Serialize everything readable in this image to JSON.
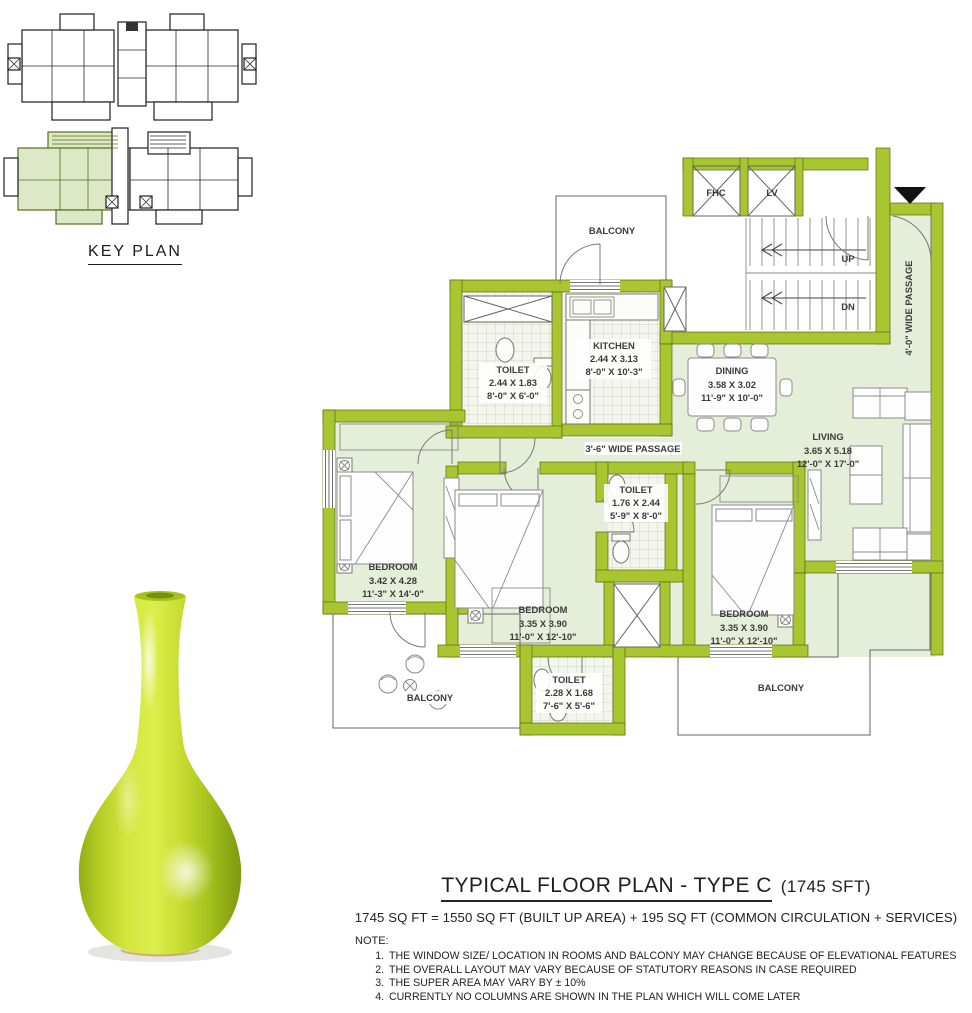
{
  "key_plan": {
    "title": "KEY PLAN"
  },
  "floor_plan": {
    "rooms": {
      "balcony_top": {
        "name": "BALCONY"
      },
      "kitchen": {
        "name": "KITCHEN",
        "metric": "2.44 X 3.13",
        "imperial": "8'-0\" X 10'-3\""
      },
      "toilet_1": {
        "name": "TOILET",
        "metric": "2.44 X 1.83",
        "imperial": "8'-0\" X 6'-0\""
      },
      "dining": {
        "name": "DINING",
        "metric": "3.58 X 3.02",
        "imperial": "11'-9\" X 10'-0\""
      },
      "living": {
        "name": "LIVING",
        "metric": "3.65 X 5.18",
        "imperial": "12'-0\" X 17'-0\""
      },
      "bedroom_1": {
        "name": "BEDROOM",
        "metric": "3.42 X 4.28",
        "imperial": "11'-3\" X 14'-0\""
      },
      "bedroom_2": {
        "name": "BEDROOM",
        "metric": "3.35 X 3.90",
        "imperial": "11'-0\" X 12'-10\""
      },
      "toilet_2": {
        "name": "TOILET",
        "metric": "1.76 X 2.44",
        "imperial": "5'-9\" X 8'-0\""
      },
      "bedroom_3": {
        "name": "BEDROOM",
        "metric": "3.35 X 3.90",
        "imperial": "11'-0\" X 12'-10\""
      },
      "toilet_3": {
        "name": "TOILET",
        "metric": "2.28 X 1.68",
        "imperial": "7'-6\" X 5'-6\""
      },
      "balcony_left": {
        "name": "BALCONY"
      },
      "balcony_right": {
        "name": "BALCONY"
      }
    },
    "annotations": {
      "fhc": "FHC",
      "lift": "LV",
      "up": "UP",
      "down": "DN",
      "passage_inner": "3'-6\" WIDE PASSAGE",
      "passage_outer": "4'-0\"  WIDE PASSAGE"
    }
  },
  "footer": {
    "title": "TYPICAL FLOOR PLAN - TYPE C",
    "title_area": "(1745 SFT)",
    "area_equation": "1745 SQ FT = 1550 SQ FT (BUILT UP AREA) + 195 SQ FT (COMMON CIRCULATION + SERVICES)",
    "note_heading": "NOTE:",
    "notes": [
      "THE WINDOW SIZE/ LOCATION IN ROOMS AND BALCONY MAY CHANGE BECAUSE OF ELEVATIONAL FEATURES",
      "THE OVERALL LAYOUT MAY VARY BECAUSE OF STATUTORY REASONS IN CASE REQUIRED",
      "THE SUPER AREA MAY VARY BY ± 10%",
      "CURRENTLY NO COLUMNS ARE SHOWN IN THE PLAN WHICH WILL COME LATER"
    ]
  },
  "colors": {
    "wall_green": "#a9c52f",
    "floor_green": "#e5eed8",
    "highlight_unit": "#dde8c6",
    "vase_chartreuse": "#c9dd33",
    "text_dark": "#1e1e1e"
  }
}
